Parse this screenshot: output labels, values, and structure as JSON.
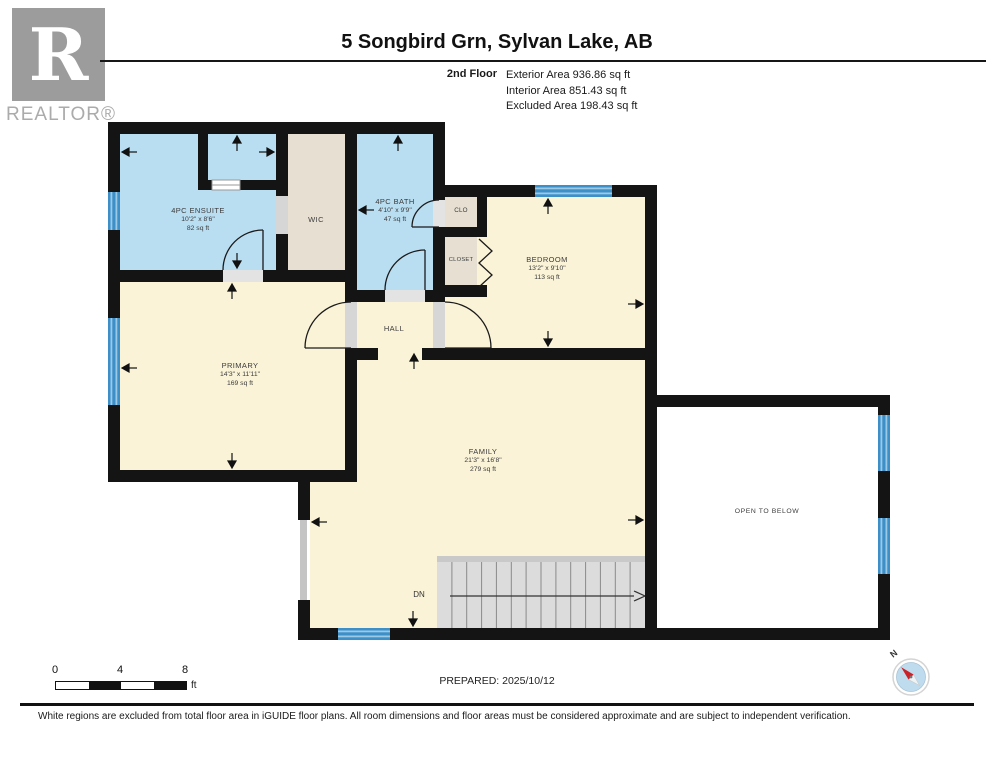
{
  "header": {
    "logo_letter": "R",
    "logo_text": "REALTOR®",
    "title": "5 Songbird Grn, Sylvan Lake, AB",
    "floor_label": "2nd Floor",
    "area_lines": [
      "Exterior Area 936.86 sq ft",
      "Interior Area 851.43 sq ft",
      "Excluded Area 198.43 sq ft"
    ]
  },
  "rooms": {
    "ensuite": {
      "name": "4PC ENSUITE",
      "dims": "10'2\" x 8'6\"",
      "area": "82 sq ft"
    },
    "wic": {
      "name": "WIC"
    },
    "bath": {
      "name": "4PC BATH",
      "dims": "4'10\" x 9'9\"",
      "area": "47 sq ft"
    },
    "clo": {
      "name": "CLO"
    },
    "closet": {
      "name": "CLOSET"
    },
    "bedroom": {
      "name": "BEDROOM",
      "dims": "13'2\" x 9'10\"",
      "area": "113 sq ft"
    },
    "primary": {
      "name": "PRIMARY",
      "dims": "14'3\" x 11'11\"",
      "area": "169 sq ft"
    },
    "hall": {
      "name": "HALL"
    },
    "family": {
      "name": "FAMILY",
      "dims": "21'3\" x 16'8\"",
      "area": "279 sq ft"
    },
    "open_to_below": {
      "name": "OPEN TO BELOW"
    },
    "stairs_label": "DN"
  },
  "footer": {
    "scale_ticks": [
      "0",
      "4",
      "8"
    ],
    "scale_unit": "ft",
    "prepared": "PREPARED: 2025/10/12",
    "compass_label": "N",
    "disclaimer": "White regions are excluded from total floor area in iGUIDE floor plans. All room dimensions and floor areas must be considered approximate and are subject to independent verification."
  },
  "colors": {
    "wall": "#141414",
    "wet_room": "#b9ddf1",
    "dry_room": "#faf3d7",
    "closet_room": "#e6dfd2",
    "window": "#3d8fc7",
    "stairs": "#dcdcdc"
  }
}
